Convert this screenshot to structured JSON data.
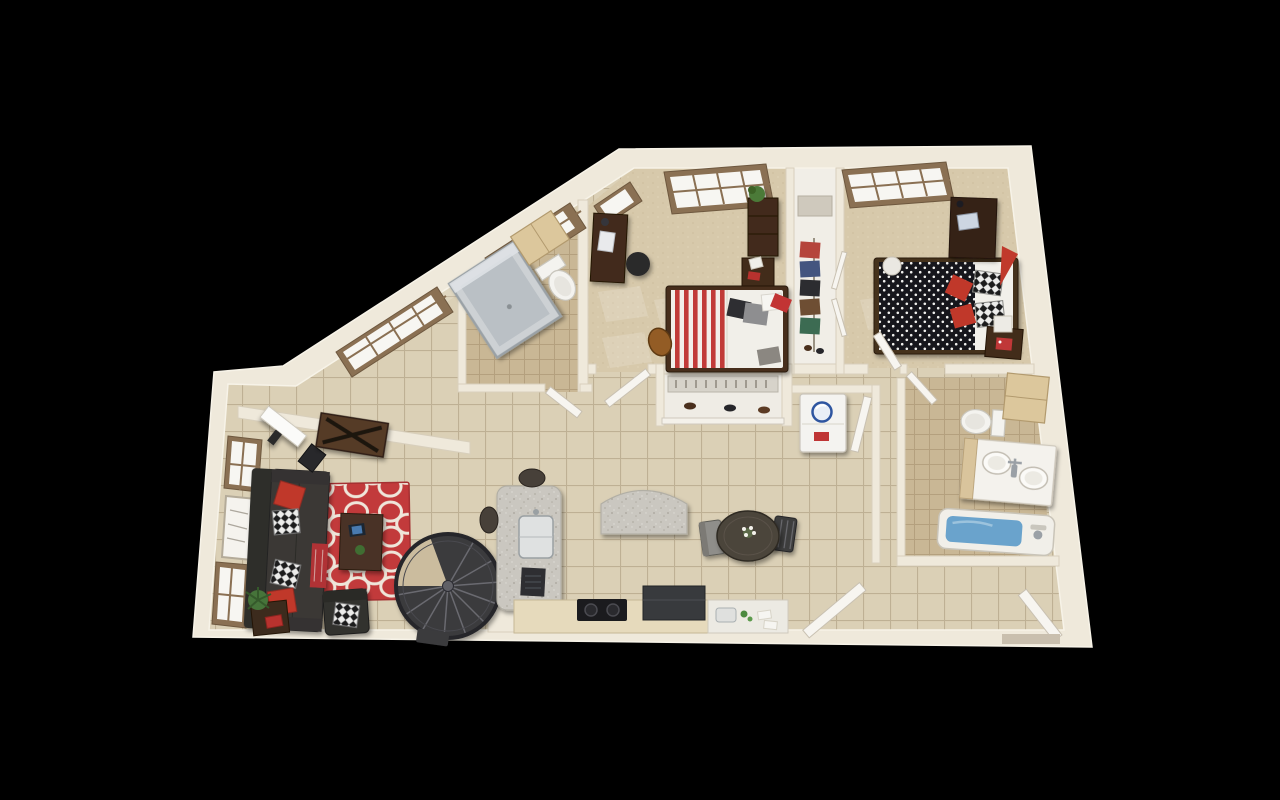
{
  "scene": {
    "description": "3D aerial floor plan rendering of a two-bedroom, two-bathroom apartment with loft spiral staircase, shown on a black background",
    "background": "#000000",
    "view": "top-down three-quarter perspective"
  },
  "palette": {
    "background": "#000000",
    "wall": "#efe9db",
    "wall_edge": "#d8cfbc",
    "floor_tile": "#d9cdb2",
    "tile_line": "#a8997c",
    "carpet": "#d7c9ab",
    "bath_tile": "#c9b795",
    "accent_red": "#c0392b",
    "rug_red": "#c23a3b",
    "dark_wood": "#422c1a",
    "charcoal": "#3a3835",
    "granite": "#c9c6bf",
    "stair_gray": "#3a3a3d",
    "water_blue": "#6aa3cc",
    "window_frame": "#8a7053",
    "door_white": "#f7f5f0"
  },
  "rooms": [
    "Living Room",
    "Study Nook",
    "Kitchen",
    "Dining Area",
    "Hallway",
    "Bedroom 1",
    "Bedroom 2",
    "Bathroom 1",
    "Bathroom 2",
    "Wardrobe Closet",
    "Shoe Closet",
    "Laundry Closet",
    "Entry"
  ],
  "furniture": {
    "living_room": [
      "charcoal sofa with red and patterned pillows",
      "red patterned area rug",
      "coffee table with tablet and plant",
      "flat-screen TV",
      "media console table",
      "armchair",
      "side table with plant and book",
      "framed artwork",
      "windows"
    ],
    "study_nook": [
      "desk with laptop",
      "desk chair",
      "angled windows"
    ],
    "kitchen": [
      "granite island with sink and laptop",
      "two bar stools",
      "granite breakfast bar",
      "cooktop",
      "range unit",
      "sink counter with dishes",
      "spiral staircase"
    ],
    "dining_area": [
      "round dining table with flowers",
      "two dining chairs"
    ],
    "bedroom_1": [
      "bed with red striped blanket",
      "desk with laptop and chair",
      "bookshelf with plant",
      "nightstand",
      "backpack",
      "window"
    ],
    "bedroom_2": [
      "bed with black polka-dot blanket and red pillows",
      "dresser with laptop",
      "nightstand with red poster",
      "white storage cube",
      "red pennant",
      "window"
    ],
    "bathroom_1": [
      "glass shower stall",
      "toilet",
      "storage cabinet"
    ],
    "bathroom_2": [
      "toilet",
      "double-sink vanity",
      "bathtub with water",
      "storage cabinet"
    ],
    "closets": [
      "hanging clothes",
      "shoe shelves",
      "stacked washer dryer"
    ],
    "doors": [
      "bedroom doors",
      "bathroom doors",
      "laundry door",
      "front entry door"
    ]
  }
}
